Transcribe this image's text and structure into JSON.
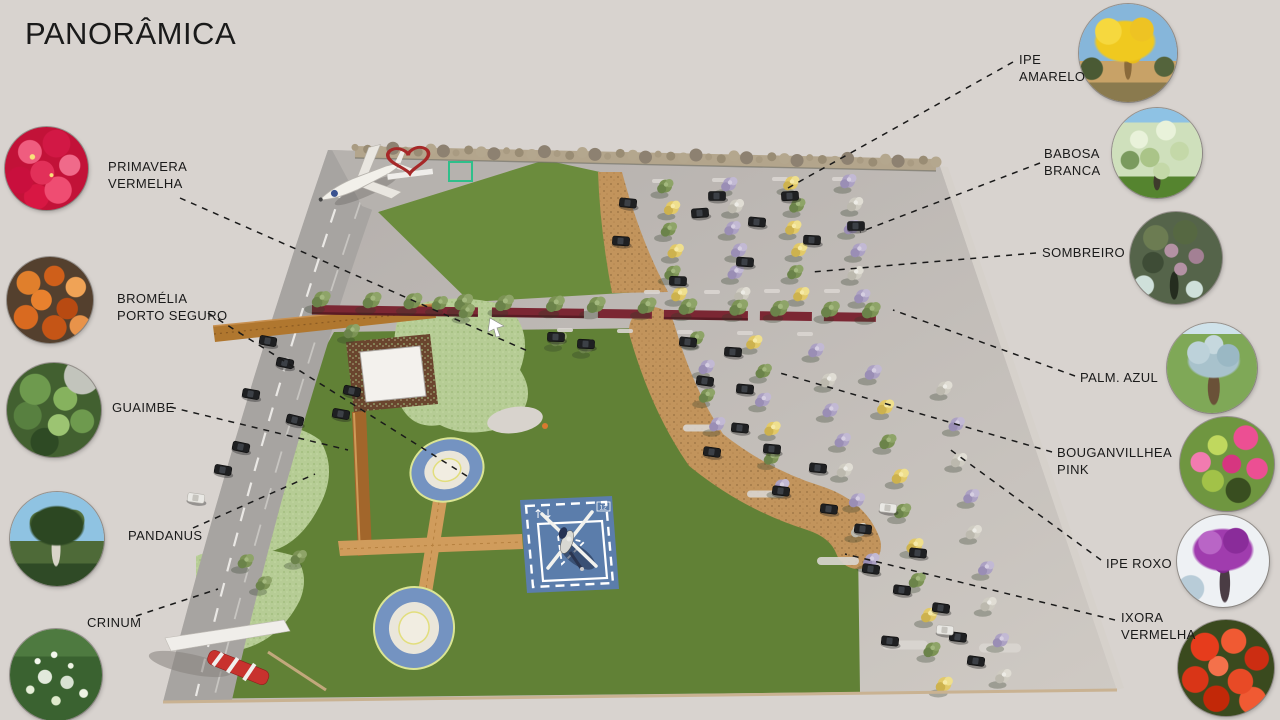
{
  "title": "PANORÂMICA",
  "plants_left": [
    {
      "id": "primavera-vermelha",
      "label": "PRIMAVERA\nVERMELHA"
    },
    {
      "id": "bromelia-porto-seguro",
      "label": "BROMÉLIA\nPORTO SEGURO"
    },
    {
      "id": "guaimbe",
      "label": "GUAIMBE"
    },
    {
      "id": "pandanus",
      "label": "PANDANUS"
    },
    {
      "id": "crinum",
      "label": "CRINUM"
    }
  ],
  "plants_right": [
    {
      "id": "ipe-amarelo",
      "label": "IPE\nAMARELO"
    },
    {
      "id": "babosa-branca",
      "label": "BABOSA\nBRANCA"
    },
    {
      "id": "sombreiro",
      "label": "SOMBREIRO"
    },
    {
      "id": "palm-azul",
      "label": "PALM.  AZUL"
    },
    {
      "id": "bouganvillhea-pink",
      "label": "BOUGANVILLHEA\nPINK"
    },
    {
      "id": "ipe-roxo",
      "label": "IPE ROXO"
    },
    {
      "id": "ixora-vermelha",
      "label": "IXORA\nVERMELHA"
    }
  ],
  "helipad": {
    "arrows": "↑↓",
    "size_mark": "12"
  },
  "colors": {
    "background": "#d8d3cf",
    "title": "#1a1a1a",
    "connector": "#1a1a1a",
    "lawn_upper": "#6b8c3d",
    "lawn_lower": "#618136",
    "parking_dark": "#b2adaa",
    "parking_light": "#cfcac4",
    "road": "#a7a4a1",
    "mulch": "#c2945c",
    "maroon_planter": "#7b2733",
    "helipad_blue": "#5b7dab",
    "pad_ring_blue": "#7493c1",
    "path_orange": "#d09c5c",
    "shrub_green": "#b6cc95",
    "tree_green": "#7c9355",
    "tree_yellow": "#e2c968",
    "tree_purple": "#aca1c3",
    "tree_white": "#cfccc2",
    "heart_red": "#a62828"
  }
}
